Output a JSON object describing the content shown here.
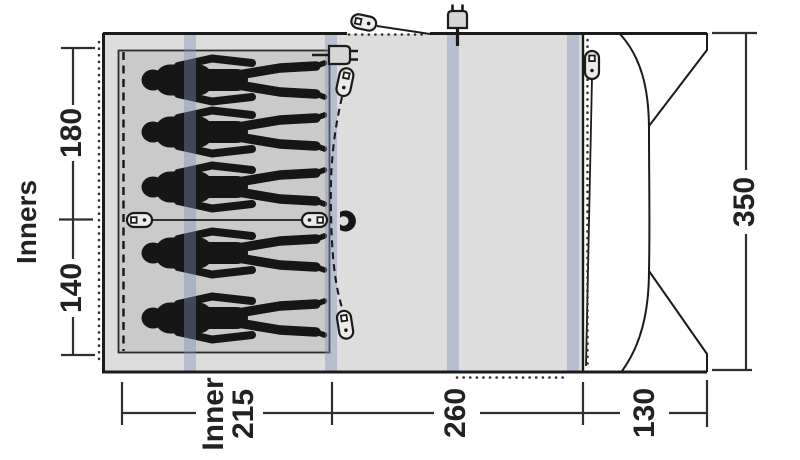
{
  "diagram": {
    "type": "tent-floorplan",
    "left_axis": {
      "label": "Inners",
      "segments": [
        {
          "value": "180"
        },
        {
          "value": "140"
        }
      ]
    },
    "right_axis": {
      "value": "350"
    },
    "bottom_axis": {
      "segments": [
        {
          "label": "Inner",
          "value": "215"
        },
        {
          "value": "260"
        },
        {
          "value": "130"
        }
      ]
    },
    "figures": {
      "count": 5,
      "arrangement": [
        3,
        2
      ]
    },
    "icons": {
      "top_guyline_toggle": "toggle-clip",
      "top_power_plug": "power-plug",
      "inner_power_plug": "power-plug",
      "divider_toggle_left": "toggle-clip",
      "divider_toggle_right": "toggle-clip",
      "inner_door_toggle_top": "toggle-clip",
      "inner_door_toggle_bottom": "toggle-clip",
      "porch_door_toggle": "toggle-clip",
      "inner_door_magnet": "magnet"
    },
    "colors": {
      "tent_fill": "#dcdddc",
      "inner_fill": "#c9cac9",
      "pole_stripe": "#b7c1d4",
      "outline": "#1b1b1b",
      "figure": "#161616",
      "dimension": "#2b2b2b",
      "porch_fill": "#ffffff"
    }
  }
}
